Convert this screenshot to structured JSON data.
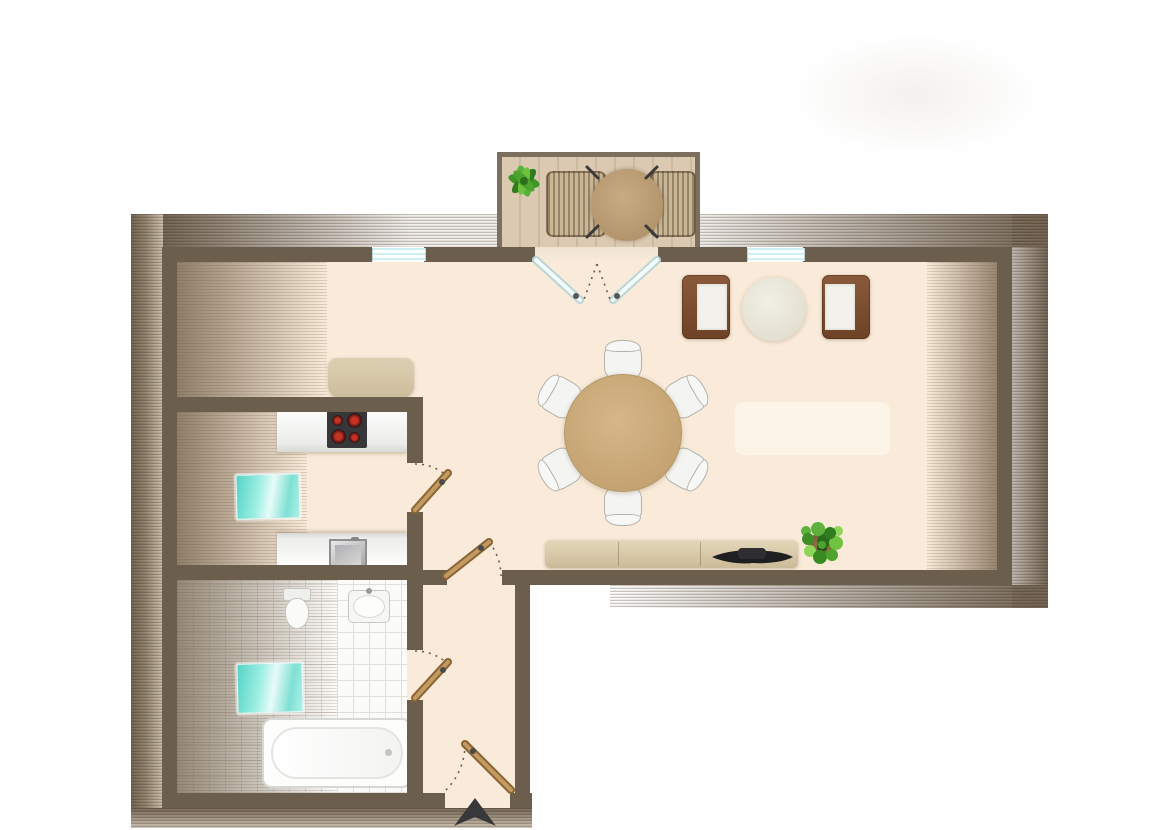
{
  "meta": {
    "title": "attic-apartment-floor-plan",
    "visible_text": "none"
  },
  "palette": {
    "wall": "#6b5e4d",
    "floor": "#f9ead9",
    "deck": "#dbcab1",
    "roof_band": "#6e5f4d",
    "counter": "#f2f2f0",
    "roof_window": "#7fe3d6",
    "wall_window": "#cdeef2",
    "door_wood": "#b98e58",
    "plant_green": "#4ea32c",
    "table_wood": "#c5a373",
    "armchair_brown": "#7d4e33",
    "sideboard_beige": "#d8c9a9",
    "tv_black": "#1f1f21",
    "tile_white": "#fbfbf9",
    "arrow_dark": "#38383a"
  },
  "floor_plan": {
    "balcony": {
      "items": [
        "potted-plant",
        "lounge-chair-left",
        "round-table-with-legs",
        "lounge-chair-right"
      ],
      "deck": "vertical-wood-planks",
      "railing_sides": [
        "top",
        "left",
        "right"
      ]
    },
    "living_room": {
      "wall_windows": 2,
      "items": [
        "french-double-door-to-balcony",
        "armchair-left",
        "round-coffee-table",
        "armchair-right",
        "cabinet-against-kitchen-wall",
        "round-dining-table",
        "dining-chairs",
        "light-rug",
        "sideboard-3-sections",
        "tv-on-sideboard",
        "potted-floor-plant"
      ],
      "dining_chair_count": 6
    },
    "kitchen": {
      "items": [
        "counter-with-cooktop-4-burners",
        "sloped-roof-window",
        "counter-with-sink"
      ]
    },
    "bathroom": {
      "items": [
        "toilet",
        "washbasin",
        "sloped-roof-window",
        "bathtub",
        "tiled-floor"
      ]
    },
    "hallway": {
      "doors": [
        "kitchen-door",
        "hall-door-to-entry"
      ]
    },
    "entry": {
      "doors": [
        "bathroom-door",
        "entrance-door"
      ],
      "marker": "entrance-arrow"
    },
    "door_swings": "dashed-arcs",
    "sloped_roof_zones": [
      "outer-perimeter-bands",
      "left-side-interior",
      "right-side-interior"
    ]
  }
}
